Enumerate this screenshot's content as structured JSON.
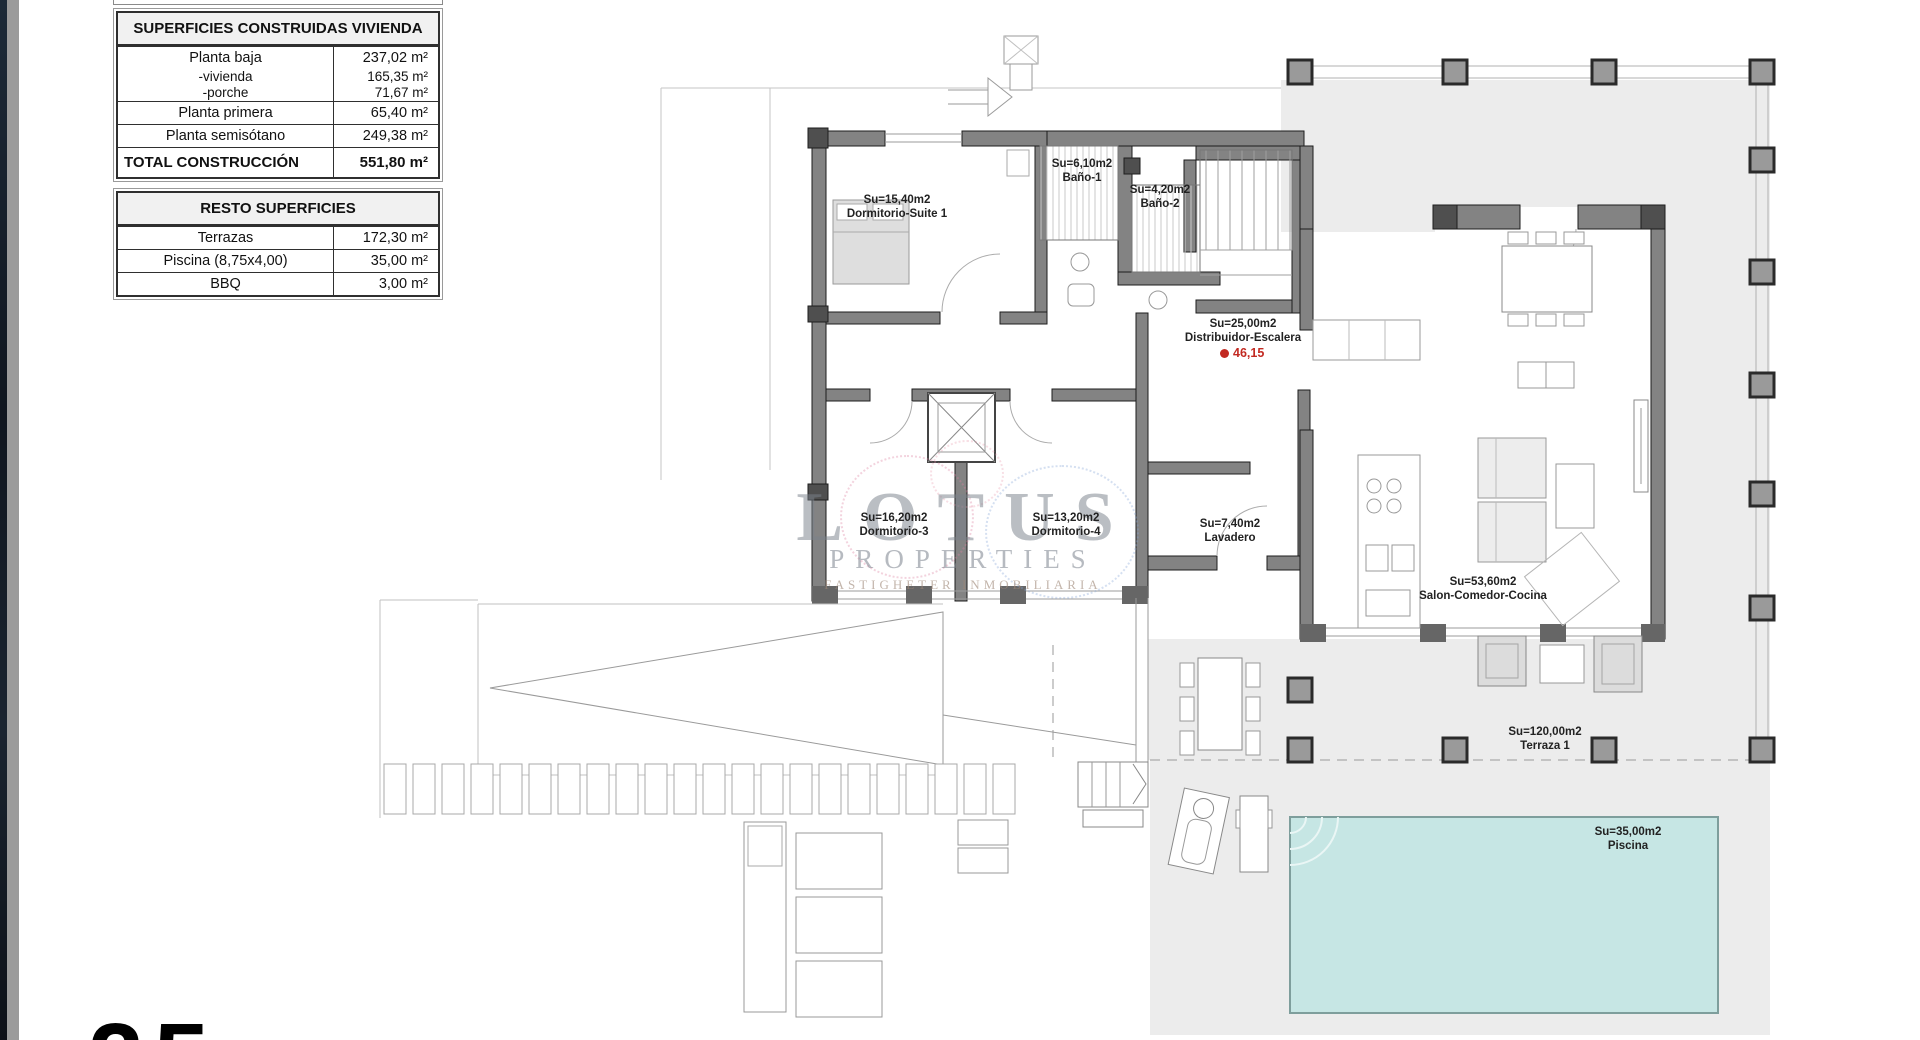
{
  "document": {
    "page_number": "25"
  },
  "colors": {
    "wall_gray": "#838383",
    "terrace_gray": "#ececec",
    "pool_teal": "#c6e6e4",
    "marker_red": "#c22a22",
    "watermark_gray": "#7a828c"
  },
  "surfaces_table": {
    "title": "SUPERFICIES CONSTRUIDAS VIVIENDA",
    "rows": [
      {
        "label": "Planta baja",
        "value": "237,02 m²"
      },
      {
        "label": "-vivienda",
        "value": "165,35 m²"
      },
      {
        "label": "-porche",
        "value": "71,67 m²"
      },
      {
        "label": "Planta primera",
        "value": "65,40 m²"
      },
      {
        "label": "Planta semisótano",
        "value": "249,38 m²"
      }
    ],
    "total_row": {
      "label": "TOTAL CONSTRUCCIÓN",
      "value": "551,80 m²"
    }
  },
  "resto_table": {
    "title": "RESTO SUPERFICIES",
    "rows": [
      {
        "label": "Terrazas",
        "value": "172,30 m²"
      },
      {
        "label": "Piscina (8,75x4,00)",
        "value": "35,00 m²"
      },
      {
        "label": "BBQ",
        "value": "3,00 m²"
      }
    ]
  },
  "watermark": {
    "title": "LOTUS",
    "subtitle": "PROPERTIES",
    "tagline": "FASTIGHETER INMOBILIARIA"
  },
  "rooms": [
    {
      "area": "Su=15,40m2",
      "name": "Dormitorio-Suite 1"
    },
    {
      "area": "Su=6,10m2",
      "name": "Baño-1"
    },
    {
      "area": "Su=4,20m2",
      "name": "Baño-2"
    },
    {
      "area": "Su=25,00m2",
      "name": "Distribuidor-Escalera"
    },
    {
      "area": "Su=16,20m2",
      "name": "Dormitorio-3"
    },
    {
      "area": "Su=13,20m2",
      "name": "Dormitorio-4"
    },
    {
      "area": "Su=7,40m2",
      "name": "Lavadero"
    },
    {
      "area": "Su=53,60m2",
      "name": "Salon-Comedor-Cocina"
    },
    {
      "area": "Su=120,00m2",
      "name": "Terraza 1"
    },
    {
      "area": "Su=35,00m2",
      "name": "Piscina"
    }
  ],
  "level_marker": {
    "value": "46,15"
  }
}
